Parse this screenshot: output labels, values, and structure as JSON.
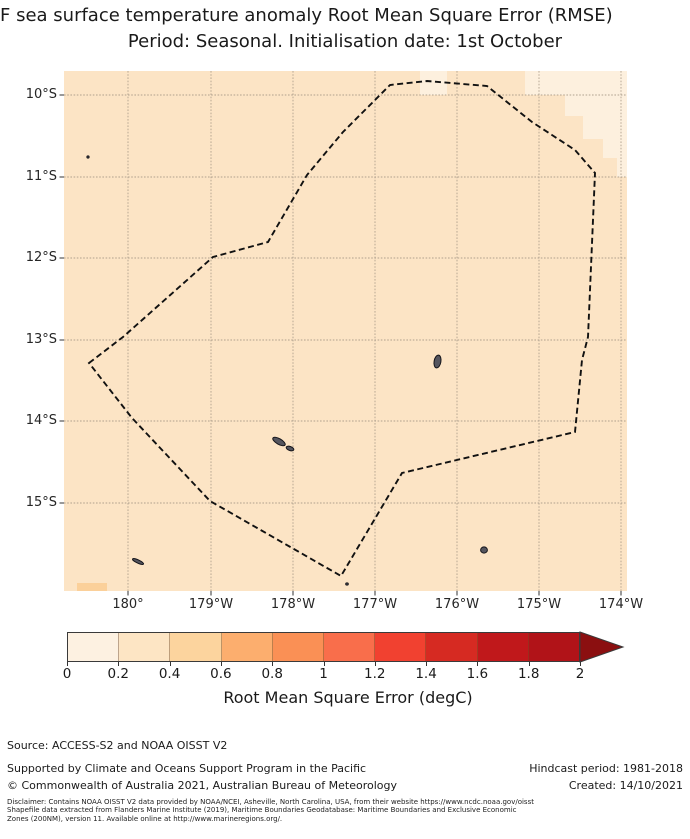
{
  "title": {
    "line1": "F sea surface temperature anomaly Root Mean Square Error (RMSE)",
    "line2": "Period: Seasonal. Initialisation date: 1st October"
  },
  "map": {
    "x_tick_labels": [
      "180°",
      "179°W",
      "178°W",
      "177°W",
      "176°W",
      "175°W",
      "174°W"
    ],
    "y_tick_labels": [
      "10°S",
      "11°S",
      "12°S",
      "13°S",
      "14°S",
      "15°S"
    ],
    "ocean_fill": "#fce4c5",
    "low_rmse_fill": "#fdf0de",
    "high_rmse_fill": "#fbd09a",
    "grid_color": "#a89a88",
    "island_fill": "#55555e",
    "island_stroke": "#14141a",
    "boundary_color": "#111111",
    "cells": [
      {
        "x": 356,
        "y": 0,
        "w": 27,
        "h": 24,
        "fill": "low"
      },
      {
        "x": 461,
        "y": 0,
        "w": 102,
        "h": 24,
        "fill": "low"
      },
      {
        "x": 501,
        "y": 24,
        "w": 62,
        "h": 21,
        "fill": "low"
      },
      {
        "x": 519,
        "y": 45,
        "w": 44,
        "h": 23,
        "fill": "low"
      },
      {
        "x": 539,
        "y": 68,
        "w": 24,
        "h": 19,
        "fill": "low"
      },
      {
        "x": 553,
        "y": 87,
        "w": 10,
        "h": 19,
        "fill": "low"
      },
      {
        "x": 13,
        "y": 512,
        "w": 30,
        "h": 8,
        "fill": "high"
      }
    ],
    "eez_points": [
      [
        25,
        292
      ],
      [
        59,
        266
      ],
      [
        149,
        186
      ],
      [
        204,
        171
      ],
      [
        243,
        104
      ],
      [
        279,
        61
      ],
      [
        326,
        14
      ],
      [
        363,
        10
      ],
      [
        423,
        15
      ],
      [
        468,
        51
      ],
      [
        511,
        79
      ],
      [
        531,
        102
      ],
      [
        524,
        266
      ],
      [
        518,
        289
      ],
      [
        511,
        361
      ],
      [
        338,
        402
      ],
      [
        277,
        505
      ],
      [
        146,
        430
      ],
      [
        68,
        347
      ]
    ],
    "islands": [
      {
        "cx": 215,
        "cy": 370.5,
        "rx": 7,
        "ry": 2.8,
        "rot": 30
      },
      {
        "cx": 226,
        "cy": 377.5,
        "rx": 4,
        "ry": 2,
        "rot": 20
      },
      {
        "cx": 373.5,
        "cy": 290.5,
        "rx": 3.4,
        "ry": 6.5,
        "rot": 10
      },
      {
        "cx": 420,
        "cy": 479,
        "rx": 3.4,
        "ry": 3.1,
        "rot": 0
      },
      {
        "cx": 74,
        "cy": 490.5,
        "rx": 6,
        "ry": 1.6,
        "rot": 25
      },
      {
        "cx": 24,
        "cy": 86,
        "rx": 1.1,
        "ry": 1.1,
        "rot": 0
      },
      {
        "cx": 283,
        "cy": 513,
        "rx": 1.3,
        "ry": 1.1,
        "rot": 0
      }
    ]
  },
  "colorbar": {
    "label": "Root Mean Square Error (degC)",
    "tick_labels": [
      "0",
      "0.2",
      "0.4",
      "0.6",
      "0.8",
      "1",
      "1.2",
      "1.4",
      "1.6",
      "1.8",
      "2"
    ],
    "segment_colors": [
      "#fdf1e1",
      "#fde5c4",
      "#fcd49e",
      "#fcae6e",
      "#fa9055",
      "#f96e4b",
      "#f14130",
      "#d62a22",
      "#c0181b",
      "#b11318"
    ],
    "arrow_color": "#8b0f10",
    "edge_color": "#3a3a3a"
  },
  "footer": {
    "source": "Source: ACCESS-S2 and NOAA OISST V2",
    "supported": "Supported by Climate and Oceans Support Program in the Pacific",
    "copyright": "© Commonwealth of Australia 2021, Australian Bureau of Meteorology",
    "hindcast": "Hindcast period: 1981-2018",
    "created": "Created: 14/10/2021",
    "disclaimer": [
      "Disclaimer: Contains NOAA OISST V2 data provided by NOAA/NCEI, Asheville, North Carolina, USA, from their website https://www.ncdc.noaa.gov/oisst",
      "Shapefile data extracted from Flanders Marine Institute (2019), Maritime Boundaries Geodatabase: Maritime Boundaries and Exclusive Economic",
      "Zones (200NM), version 11. Available online at http://www.marineregions.org/."
    ]
  },
  "chart_data": {
    "type": "heatmap",
    "title": "F sea surface temperature anomaly Root Mean Square Error (RMSE)",
    "subtitle": "Period: Seasonal. Initialisation date: 1st October",
    "x_tick_labels": [
      "180°",
      "179°W",
      "178°W",
      "177°W",
      "176°W",
      "175°W",
      "174°W"
    ],
    "y_tick_labels": [
      "10°S",
      "11°S",
      "12°S",
      "13°S",
      "14°S",
      "15°S"
    ],
    "map_extent_approx": {
      "lon": [
        180.8,
        173.9
      ],
      "lat_S": [
        9.7,
        16.1
      ]
    },
    "colorbar": {
      "label": "Root Mean Square Error (degC)",
      "ticks": [
        0,
        0.2,
        0.4,
        0.6,
        0.8,
        1,
        1.2,
        1.4,
        1.6,
        1.8,
        2
      ],
      "range": [
        0,
        2
      ],
      "extend": "max",
      "colors": [
        "#fdf1e1",
        "#fde5c4",
        "#fcd49e",
        "#fcae6e",
        "#fa9055",
        "#f96e4b",
        "#f14130",
        "#d62a22",
        "#c0181b",
        "#b11318"
      ],
      "extend_color": "#8b0f10"
    },
    "values_summary": [
      {
        "area": "most of mapped region (EEZ interior and surrounding ocean)",
        "rmse_degC": "0.2-0.4"
      },
      {
        "area": "northeast corner cells (north of ~12°S, east of ~175.5°W, stair-step pattern)",
        "rmse_degC": "0-0.2"
      },
      {
        "area": "small cell at southwest corner near 180°, 16°S",
        "rmse_degC": "0.4-0.6"
      }
    ],
    "overlays": [
      "dashed black polygon: EEZ boundary (200NM)",
      "small dark islands: Wallis (~176.2°W, 13.3°S), Futuna and Alofi (~178°W, 14.3°S), islet (~175.6°W, 15.6°S), islets near 180°"
    ]
  }
}
